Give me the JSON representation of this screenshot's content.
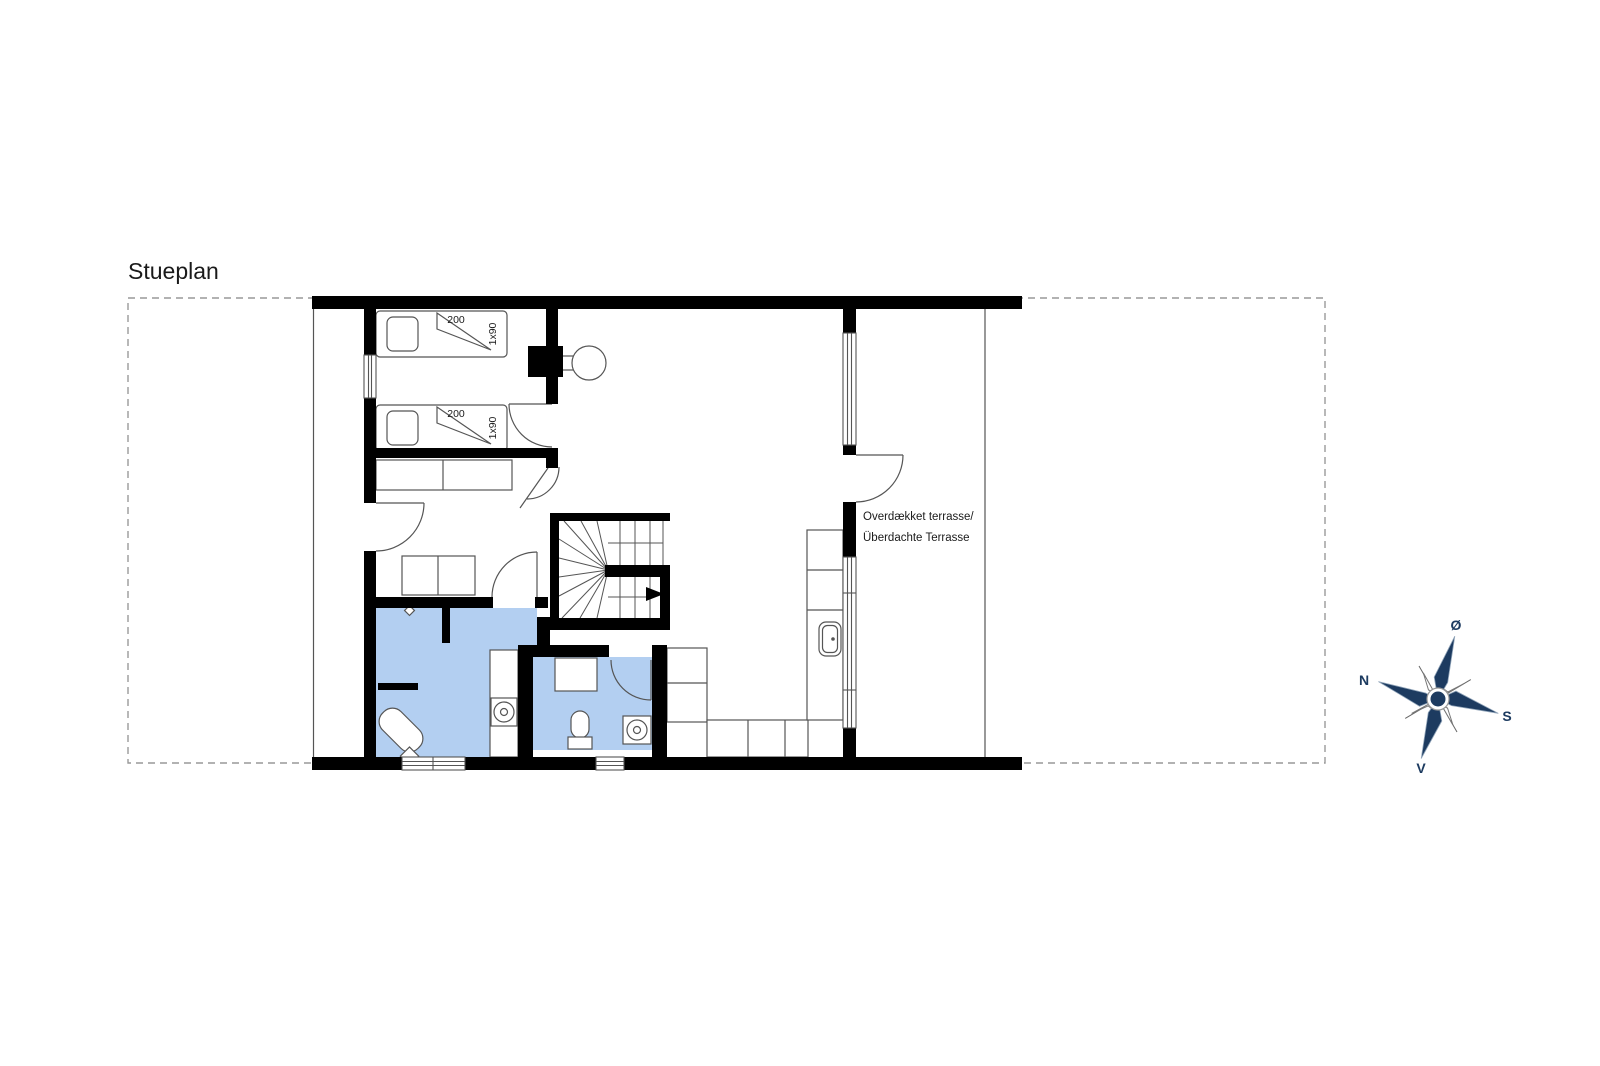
{
  "title": "Stueplan",
  "floor_plan": {
    "beds": {
      "bed1": {
        "length_label": "200",
        "width_label": "1x90"
      },
      "bed2": {
        "length_label": "200",
        "width_label": "1x90"
      }
    },
    "terrace": {
      "label_line1": "Overdækket terrasse/",
      "label_line2": "Überdachte Terrasse"
    }
  },
  "compass": {
    "east_label": "Ø",
    "north_label": "N",
    "south_label": "S",
    "west_label": "V"
  },
  "colors": {
    "wall": "#000000",
    "bathroom_fill": "#b3cff1",
    "furniture_line": "#555555",
    "site_dash": "#999999",
    "compass_navy": "#1d3b60",
    "text": "#1a1a1a"
  }
}
